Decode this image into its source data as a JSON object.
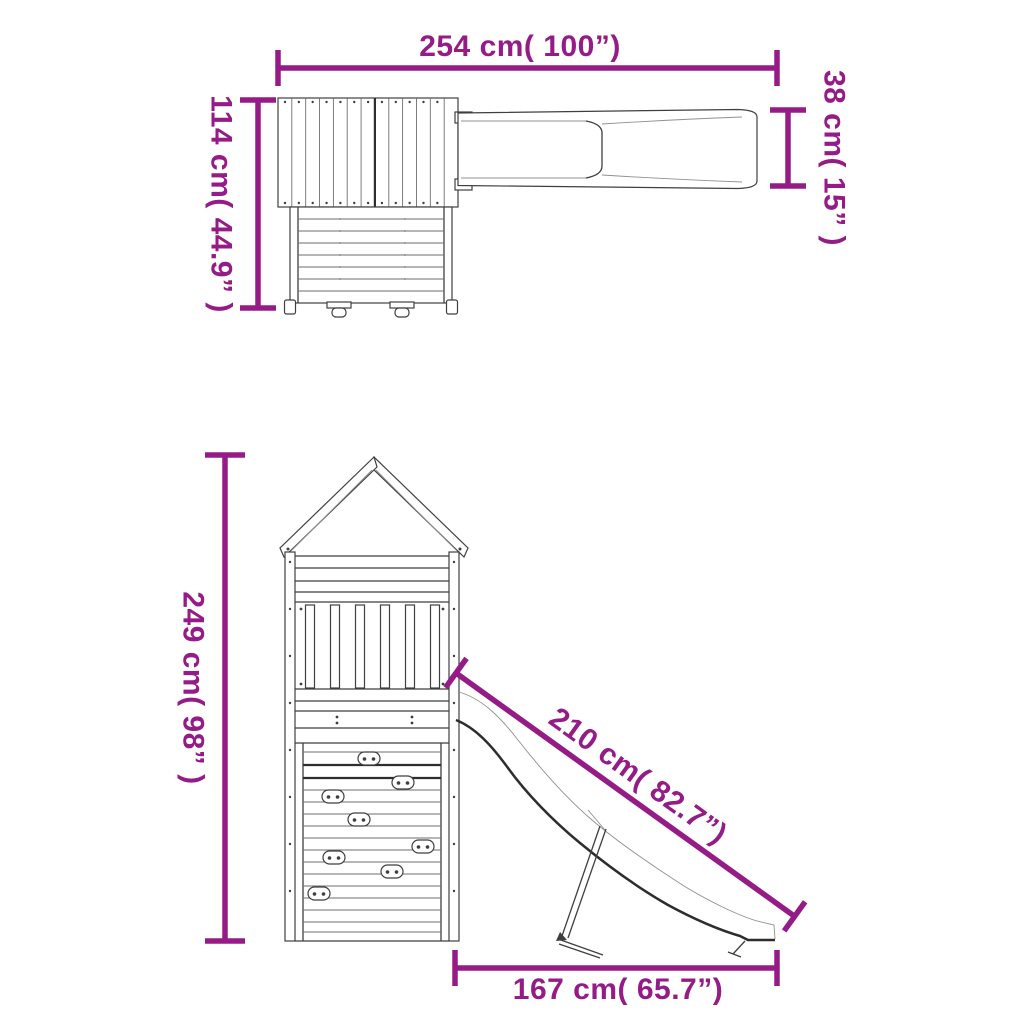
{
  "colors": {
    "accent": "#951b87",
    "line": "#3f3f3f"
  },
  "dimensions": [
    {
      "id": "overall-width",
      "label": "254 cm( 100”)",
      "cm": 254,
      "inches": 100,
      "view": "top",
      "orientation": "horizontal"
    },
    {
      "id": "house-depth",
      "label": "114 cm( 44.9” )",
      "cm": 114,
      "inches": 44.9,
      "view": "top",
      "orientation": "vertical"
    },
    {
      "id": "slide-width",
      "label": "38 cm( 15” )",
      "cm": 38,
      "inches": 15,
      "view": "top",
      "orientation": "vertical"
    },
    {
      "id": "tower-height",
      "label": "249 cm( 98” )",
      "cm": 249,
      "inches": 98,
      "view": "front",
      "orientation": "vertical"
    },
    {
      "id": "slide-length",
      "label": "210 cm( 82.7”)",
      "cm": 210,
      "inches": 82.7,
      "view": "front",
      "orientation": "diagonal"
    },
    {
      "id": "base-width",
      "label": "167 cm( 65.7”)",
      "cm": 167,
      "inches": 65.7,
      "view": "front",
      "orientation": "horizontal"
    }
  ]
}
